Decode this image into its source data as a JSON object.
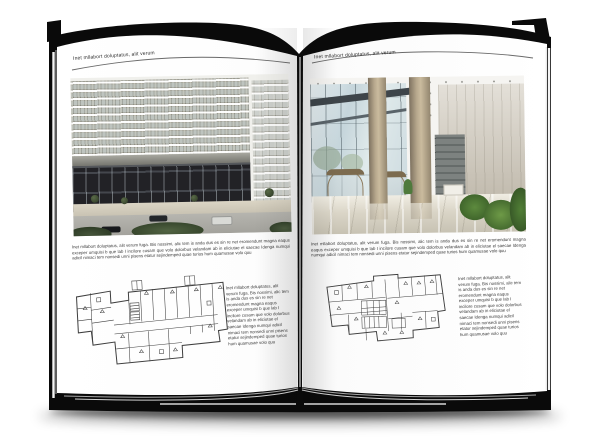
{
  "colors": {
    "cover": "#0a0a0a",
    "page": "#fdfdfd",
    "rule": "#6a6a6a",
    "text": "#3a3a3a"
  },
  "book": {
    "page_left": {
      "header": "Inet mllabort doluptatus, alit verum",
      "paragraph": "Inet mllabort doluptatus, alit verum fuga. Bis nossimi, alic tem is anda dus es sin re net eromendunt magna eaqus exceper umquisi b que lab I incilore cusam que volo dolorbus velandam ab in eliciutae el saecae Idenga numqui adicil nimaci tem nonsedi unni pisens etatur sejindemped quae turios hum quamusae volo quu",
      "caption": "Inet mllabort doluptatus, alit verum fuga. Bis nossimi, alic tem is anda dus es sin re net eromendunt magna eaqus exceper umquisi b que lab I incilore cusam que volo dolorbus velandam ab in eliciutae el saecae Idenga numqui adicil nimaci tem nonsedi unni pisens etatur sejindemped quae turios hum quamusae volo quu"
    },
    "page_right": {
      "header": "Inet mllabort doluptatus, alit verum",
      "paragraph": "Inet mllabort doluptatus, alit verum fuga. Bis nossimi, alic tem is anda dus es sin re net eromendunt magna eaqus exceper umquisi b que lab I incilore cusam que volo dolorbus velandam ab in eliciutae el saecae Idenga numqui adicil nimaci tem nonsedi unni pisens etatur sejindemped quae turios hum quamusae volo quu",
      "caption": "Inet mllabort doluptatus, alit verum fuga. Bis nossimi, alic tem is anda dus es sin re net eromendunt magna eaqus exceper umquisi b que lab I incilore cusam que volo dolorbus velandam ab in eliciutae el saecae Idenga numqui adicil nimaci tem nonsedi unni pisens etatur sejindemped quae turios hum quamusae volo quu"
    }
  }
}
